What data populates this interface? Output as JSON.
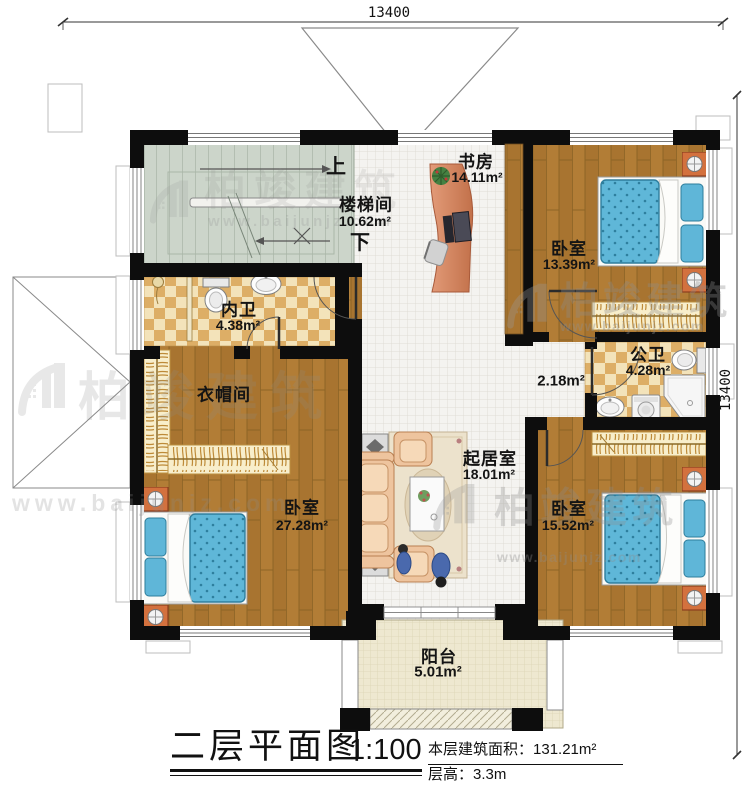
{
  "watermark": {
    "brand": "柏竣建筑",
    "site": "www.baijunjz.com"
  },
  "dimensions": {
    "top": "13400",
    "right": "13400"
  },
  "rooms": {
    "study": {
      "name": "书房",
      "area": "14.11m²"
    },
    "stairwell": {
      "name": "楼梯间",
      "area": "10.62m²",
      "up": "上",
      "down": "下"
    },
    "bedroom_top_right": {
      "name": "卧室",
      "area": "13.39m²"
    },
    "inner_bath": {
      "name": "内卫",
      "area": "4.38m²"
    },
    "public_bath": {
      "name": "公卫",
      "area": "4.28m²"
    },
    "corridor": {
      "area": "2.18m²"
    },
    "cloakroom": {
      "name": "衣帽间"
    },
    "living": {
      "name": "起居室",
      "area": "18.01m²"
    },
    "bedroom_left": {
      "name": "卧室",
      "area": "27.28m²"
    },
    "bedroom_bottom_right": {
      "name": "卧室",
      "area": "15.52m²"
    },
    "balcony": {
      "name": "阳台",
      "area": "5.01m²"
    }
  },
  "title_block": {
    "title": "二层平面图",
    "scale": "1:100",
    "area_label": "本层建筑面积：",
    "area_value": "131.21m²",
    "height_label": "层高：",
    "height_value": "3.3m"
  }
}
